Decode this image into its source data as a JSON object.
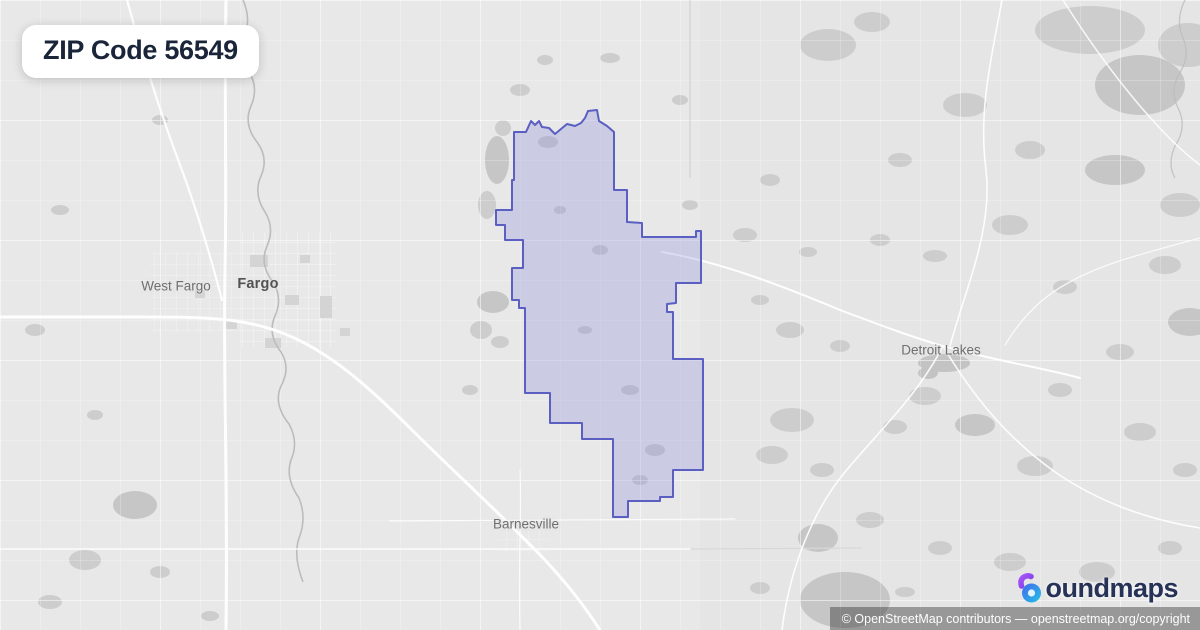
{
  "badge": {
    "title": "ZIP Code 56549"
  },
  "map": {
    "labels": [
      {
        "id": "west-fargo",
        "text": "West Fargo"
      },
      {
        "id": "fargo",
        "text": "Fargo"
      },
      {
        "id": "detroit-lakes",
        "text": "Detroit Lakes"
      },
      {
        "id": "barnesville",
        "text": "Barnesville"
      }
    ],
    "boundary": {
      "zip": "56549",
      "stroke": "#5b5fc2",
      "fill": "rgba(128,132,214,0.28)",
      "points": [
        [
          514,
          132
        ],
        [
          526,
          132
        ],
        [
          531,
          121
        ],
        [
          535,
          125
        ],
        [
          539,
          121
        ],
        [
          542,
          127
        ],
        [
          549,
          128
        ],
        [
          555,
          134
        ],
        [
          561,
          129
        ],
        [
          567,
          124
        ],
        [
          575,
          126
        ],
        [
          581,
          123
        ],
        [
          585,
          118
        ],
        [
          588,
          111
        ],
        [
          597,
          110
        ],
        [
          599,
          121
        ],
        [
          607,
          126
        ],
        [
          614,
          132
        ],
        [
          614,
          190
        ],
        [
          627,
          190
        ],
        [
          627,
          222
        ],
        [
          642,
          223
        ],
        [
          642,
          237
        ],
        [
          696,
          237
        ],
        [
          696,
          231
        ],
        [
          701,
          231
        ],
        [
          701,
          283
        ],
        [
          676,
          283
        ],
        [
          676,
          303
        ],
        [
          667,
          304
        ],
        [
          667,
          312
        ],
        [
          673,
          312
        ],
        [
          673,
          359
        ],
        [
          703,
          359
        ],
        [
          703,
          470
        ],
        [
          673,
          470
        ],
        [
          673,
          497
        ],
        [
          660,
          497
        ],
        [
          660,
          501
        ],
        [
          628,
          501
        ],
        [
          628,
          517
        ],
        [
          613,
          517
        ],
        [
          613,
          439
        ],
        [
          582,
          439
        ],
        [
          582,
          423
        ],
        [
          550,
          423
        ],
        [
          550,
          393
        ],
        [
          525,
          393
        ],
        [
          525,
          308
        ],
        [
          519,
          308
        ],
        [
          519,
          300
        ],
        [
          512,
          300
        ],
        [
          512,
          268
        ],
        [
          523,
          268
        ],
        [
          523,
          240
        ],
        [
          505,
          240
        ],
        [
          505,
          225
        ],
        [
          496,
          225
        ],
        [
          496,
          210
        ],
        [
          512,
          210
        ],
        [
          512,
          180
        ],
        [
          514,
          180
        ]
      ]
    }
  },
  "logo": {
    "brand": "boundmaps",
    "wordmark_rest": "oundmaps",
    "icon_colors": {
      "purple": "#9333ea",
      "blue": "#4466ee",
      "cyan": "#22c3e6"
    }
  },
  "attribution": {
    "text": "© OpenStreetMap contributors — openstreetmap.org/copyright"
  }
}
